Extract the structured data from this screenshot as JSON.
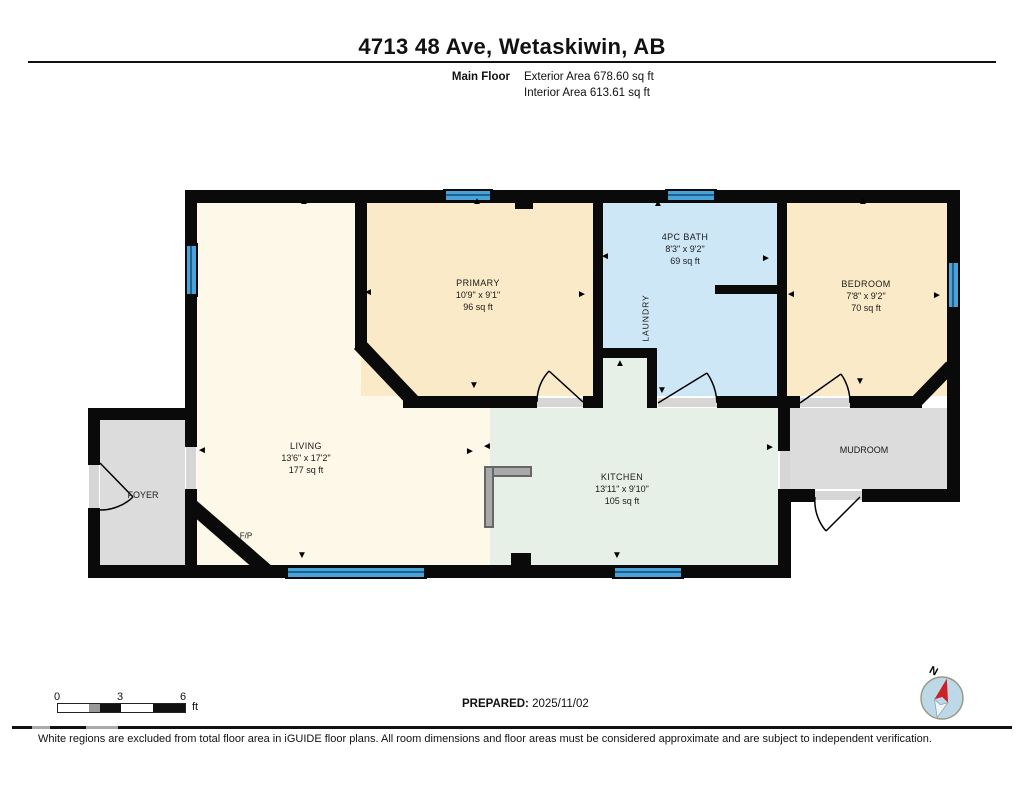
{
  "header": {
    "title": "4713 48 Ave, Wetaskiwin, AB",
    "floor_label": "Main Floor",
    "exterior_area_label": "Exterior Area 678.60 sq ft",
    "interior_area_label": "Interior Area 613.61 sq ft"
  },
  "rooms": {
    "living": {
      "name": "LIVING",
      "dims": "13'6\" x 17'2\"",
      "area": "177 sq ft"
    },
    "primary": {
      "name": "PRIMARY",
      "dims": "10'9\" x 9'1\"",
      "area": "96 sq ft"
    },
    "bath": {
      "name": "4PC BATH",
      "dims": "8'3\" x 9'2\"",
      "area": "69 sq ft"
    },
    "laundry": {
      "name": "LAUNDRY"
    },
    "bedroom": {
      "name": "BEDROOM",
      "dims": "7'8\" x 9'2\"",
      "area": "70 sq ft"
    },
    "kitchen": {
      "name": "KITCHEN",
      "dims": "13'11\" x 9'10\"",
      "area": "105 sq ft"
    },
    "mudroom": {
      "name": "MUDROOM"
    },
    "foyer": {
      "name": "FOYER"
    },
    "fireplace_label": "F/P"
  },
  "scale_bar": {
    "tick_0": "0",
    "tick_3": "3",
    "tick_6": "6",
    "unit": "ft"
  },
  "prepared": {
    "label": "PREPARED:",
    "date": "2025/11/02"
  },
  "compass": {
    "north_label": "N"
  },
  "disclaimer": "White regions are excluded from total floor area in iGUIDE floor plans. All room dimensions and floor areas must be considered approximate and are subject to independent verification.",
  "icons": {
    "arrow_up": "▲",
    "arrow_down": "▼",
    "arrow_left": "◄",
    "arrow_right": "►"
  },
  "colors": {
    "living": "#fdf8e7",
    "tanroom": "#faeac8",
    "bathblue": "#cde7f7",
    "mint": "#e7f0e6",
    "grayroom": "#dcdcdc",
    "winblue": "#4aa3d8",
    "wall": "#0a0a0a",
    "needle": "#cc2127"
  }
}
